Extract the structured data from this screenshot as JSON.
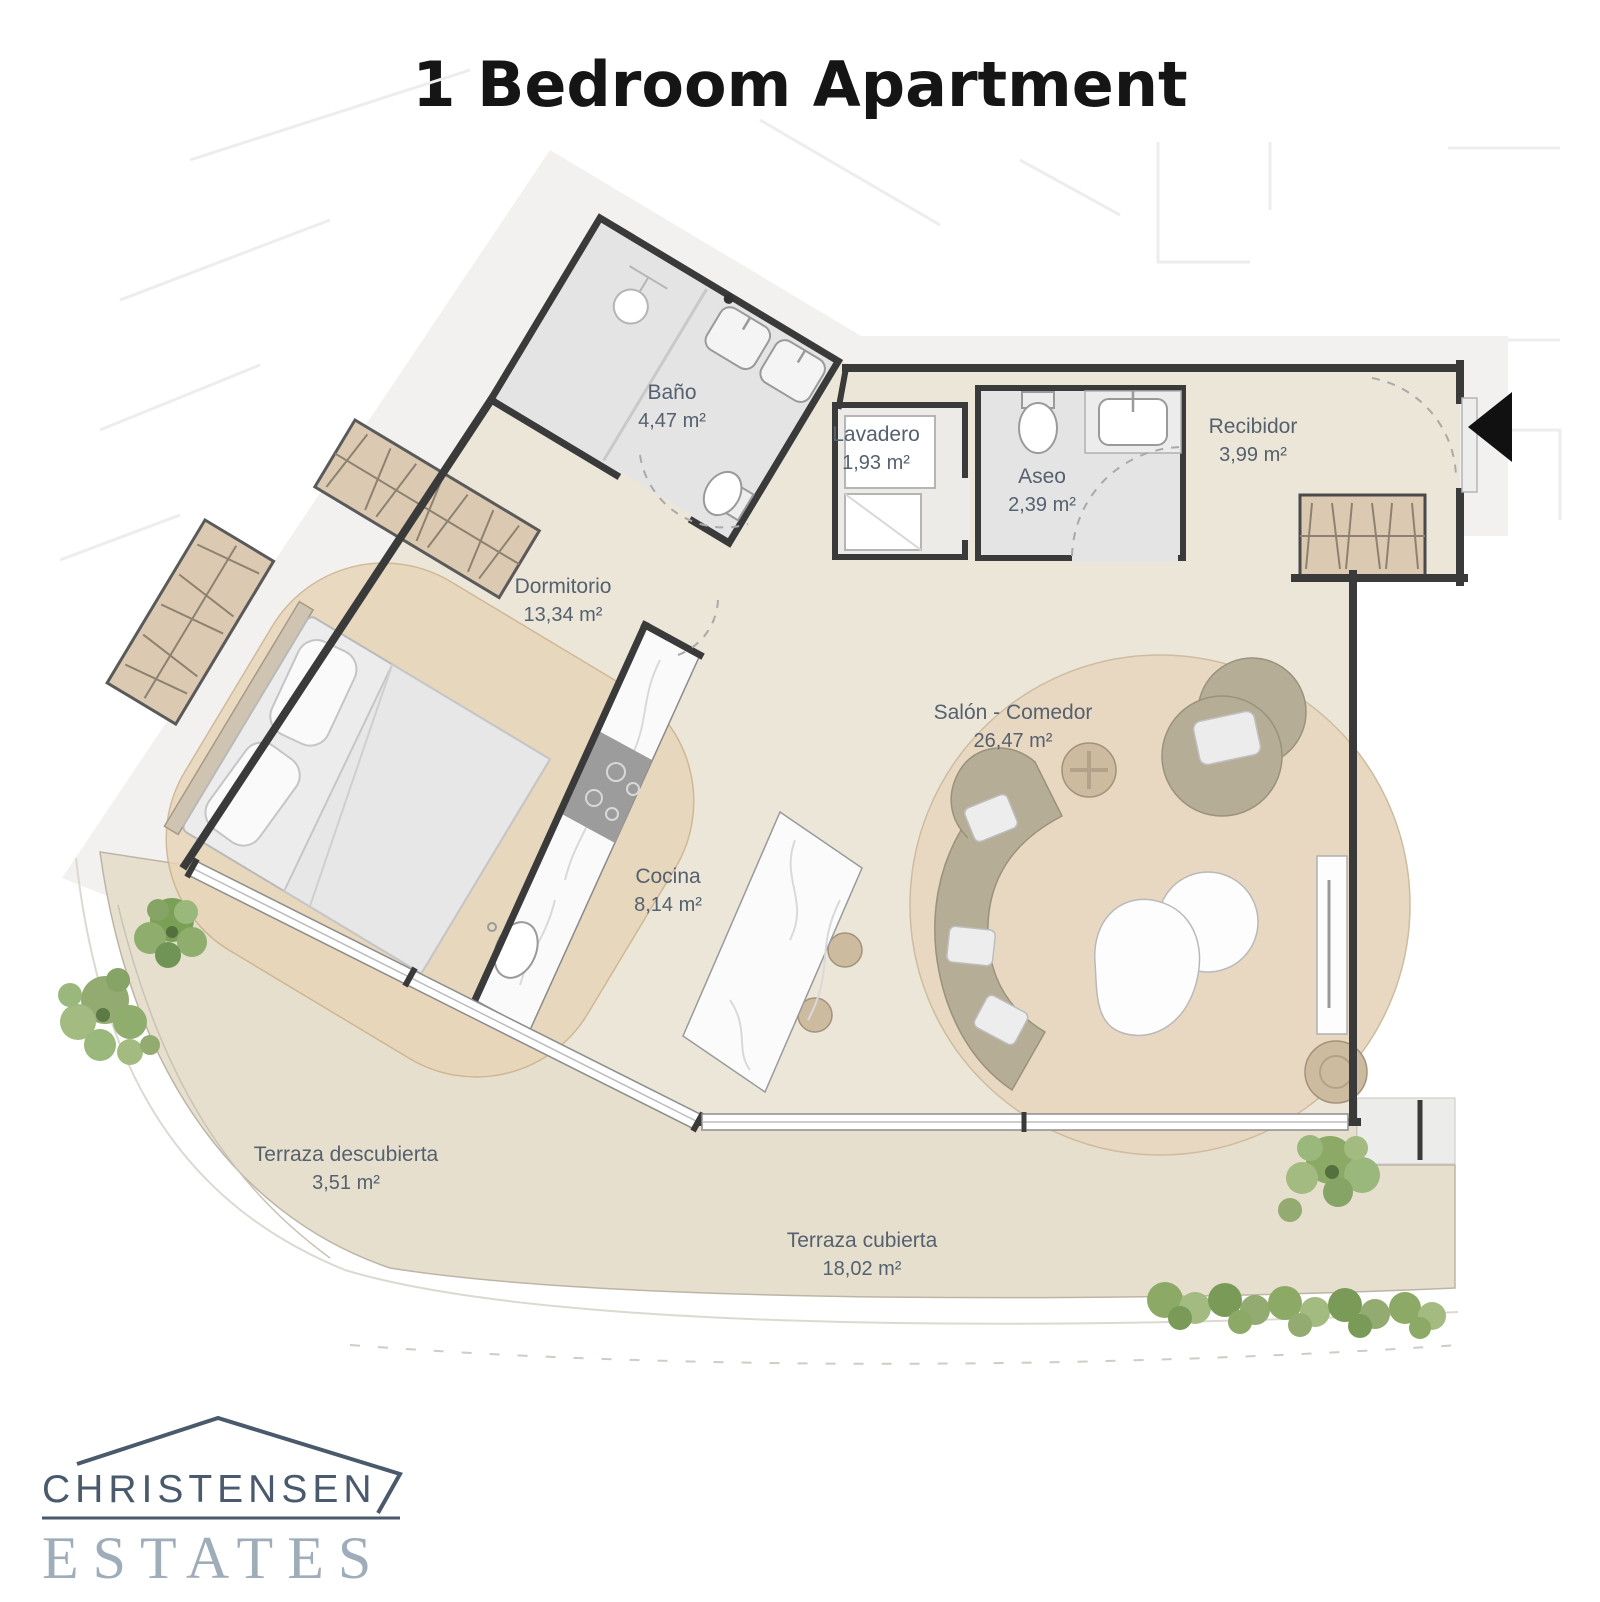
{
  "title": "1 Bedroom Apartment",
  "rooms": [
    {
      "name": "Baño",
      "area": "4,47 m²"
    },
    {
      "name": "Lavadero",
      "area": "1,93 m²"
    },
    {
      "name": "Aseo",
      "area": "2,39 m²"
    },
    {
      "name": "Recibidor",
      "area": "3,99 m²"
    },
    {
      "name": "Dormitorio",
      "area": "13,34 m²"
    },
    {
      "name": "Cocina",
      "area": "8,14 m²"
    },
    {
      "name": "Salón - Comedor",
      "area": "26,47 m²"
    },
    {
      "name": "Terraza descubierta",
      "area": "3,51 m²"
    },
    {
      "name": "Terraza cubierta",
      "area": "18,02 m²"
    }
  ],
  "logo": {
    "line1": "CHRISTENSEN",
    "line2": "ESTATES"
  },
  "colors": {
    "wall": "#3a3a3a",
    "interior_floor": "#ece6d9",
    "terrace_floor": "#e7dfce",
    "wet_room_floor": "#e4e4e5",
    "rug": "#e9d8c1",
    "furniture_olive": "#b5ad95",
    "wood_tan": "#dbcab1",
    "label_text": "#55616e",
    "logo_dark": "#4a5a6c",
    "logo_light": "#9fadba",
    "plant_green": "#8caa66"
  }
}
